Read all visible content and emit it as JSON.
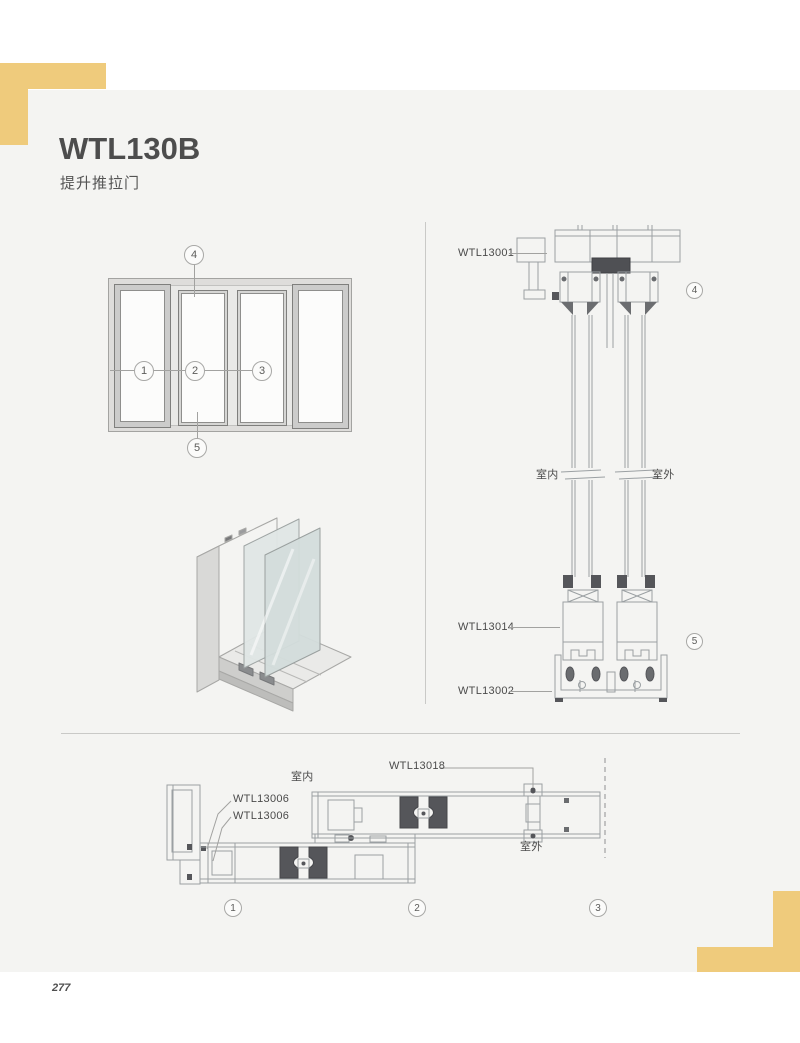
{
  "page": {
    "title": "WTL130B",
    "subtitle": "提升推拉门",
    "number": "277"
  },
  "elevation": {
    "callout_left": "1",
    "callout_mid": "2",
    "callout_right": "3",
    "callout_top": "4",
    "callout_bottom": "5"
  },
  "vertical_section": {
    "label_head": "WTL13001",
    "label_indoor": "室内",
    "label_outdoor": "室外",
    "label_sash_bottom": "WTL13014",
    "label_track": "WTL13002",
    "callout_top": "4",
    "callout_bottom": "5"
  },
  "horizontal_section": {
    "label_indoor": "室内",
    "label_lock": "WTL13018",
    "label_jamb_gasket_1": "WTL13006",
    "label_jamb_gasket_2": "WTL13006",
    "label_outdoor": "室外",
    "callout_1": "1",
    "callout_2": "2",
    "callout_3": "3"
  },
  "colors": {
    "accent": "#efcb7c",
    "background": "#f4f4f2",
    "line": "#9ba0a3",
    "dark_fill": "#55565a",
    "text": "#4d4d4d"
  }
}
